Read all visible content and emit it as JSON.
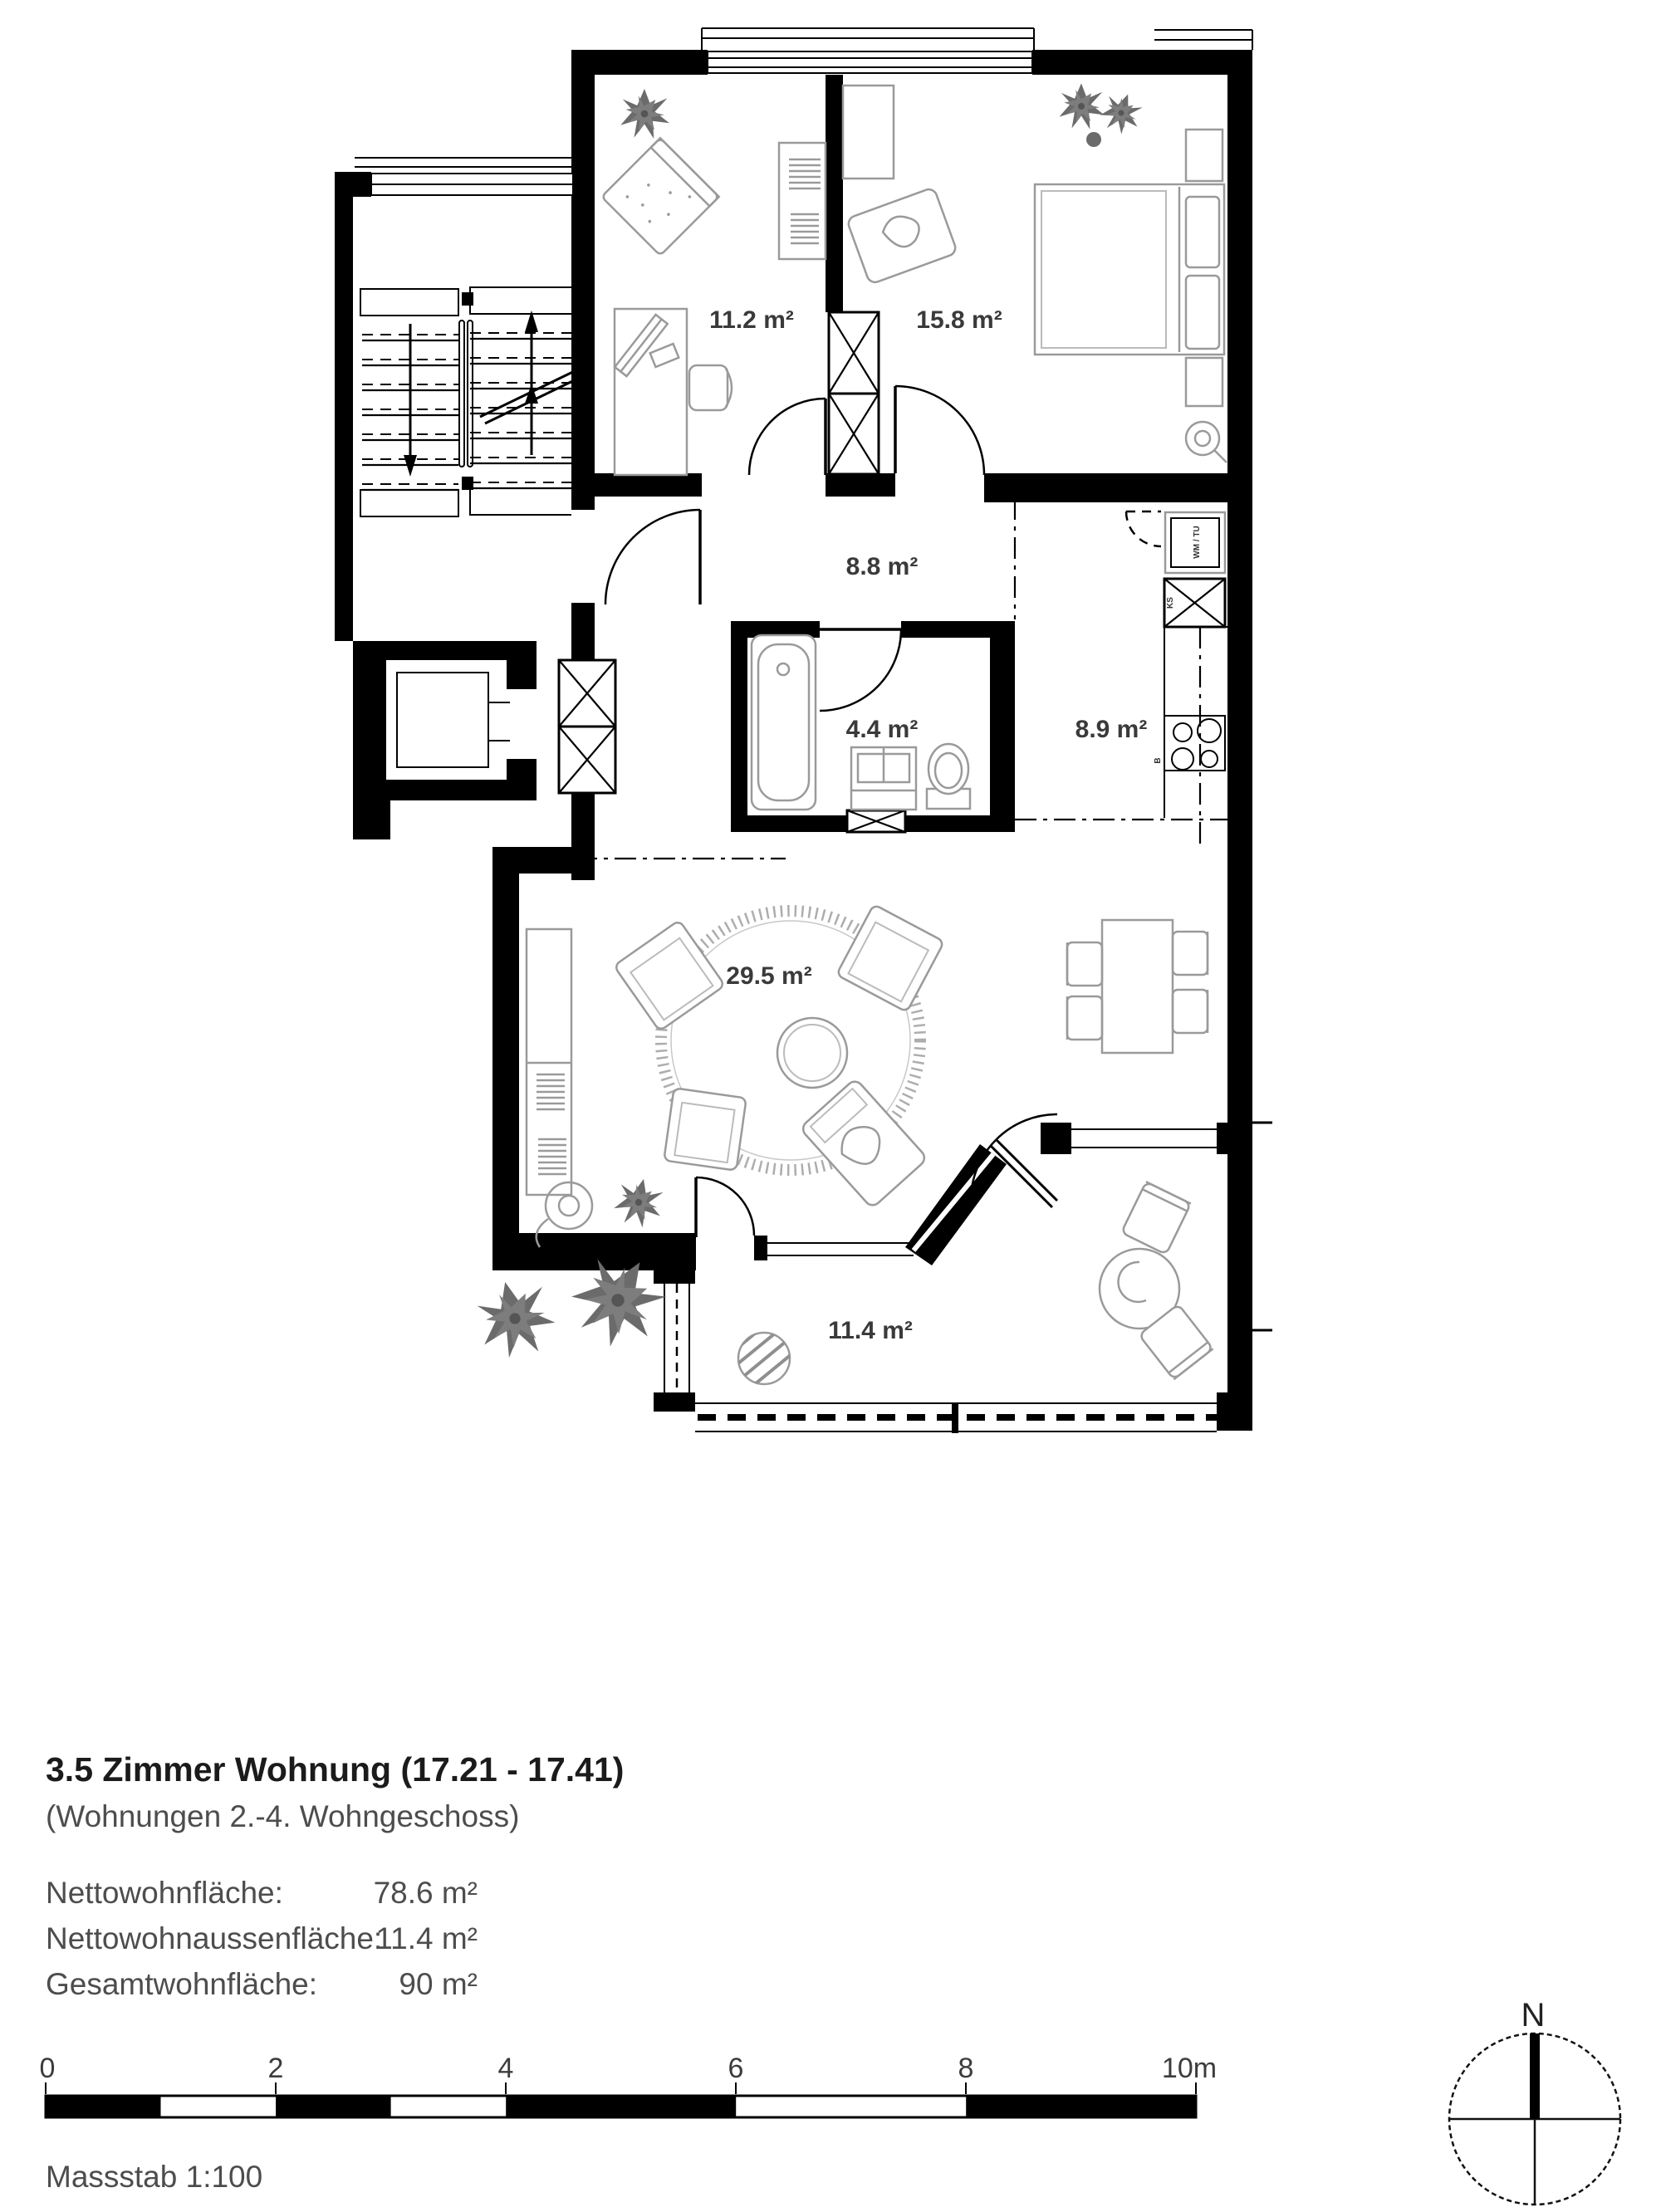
{
  "plan": {
    "room_labels": {
      "office": "11.2 m²",
      "bedroom": "15.8 m²",
      "hall": "8.8 m²",
      "bath": "4.4 m²",
      "kitchen": "8.9 m²",
      "living": "29.5 m²",
      "terrace": "11.4 m²"
    },
    "appliance_labels": {
      "washer_dryer": "WM / TU",
      "fridge": "KS",
      "hob": "B"
    }
  },
  "info": {
    "title": "3.5 Zimmer Wohnung (17.21 - 17.41)",
    "subtitle": "(Wohnungen 2.-4. Wohngeschoss)",
    "rows": [
      {
        "label": "Nettowohnfläche:",
        "value": "78.6 m²"
      },
      {
        "label": "Nettowohnaussenfläche:",
        "value": "11.4 m²"
      },
      {
        "label": "Gesamtwohnfläche:",
        "value": "90 m²"
      }
    ]
  },
  "scale_bar": {
    "ticks": [
      "0",
      "2",
      "4",
      "6",
      "8",
      "10m"
    ],
    "caption": "Massstab 1:100"
  },
  "compass": {
    "north_label": "N"
  }
}
